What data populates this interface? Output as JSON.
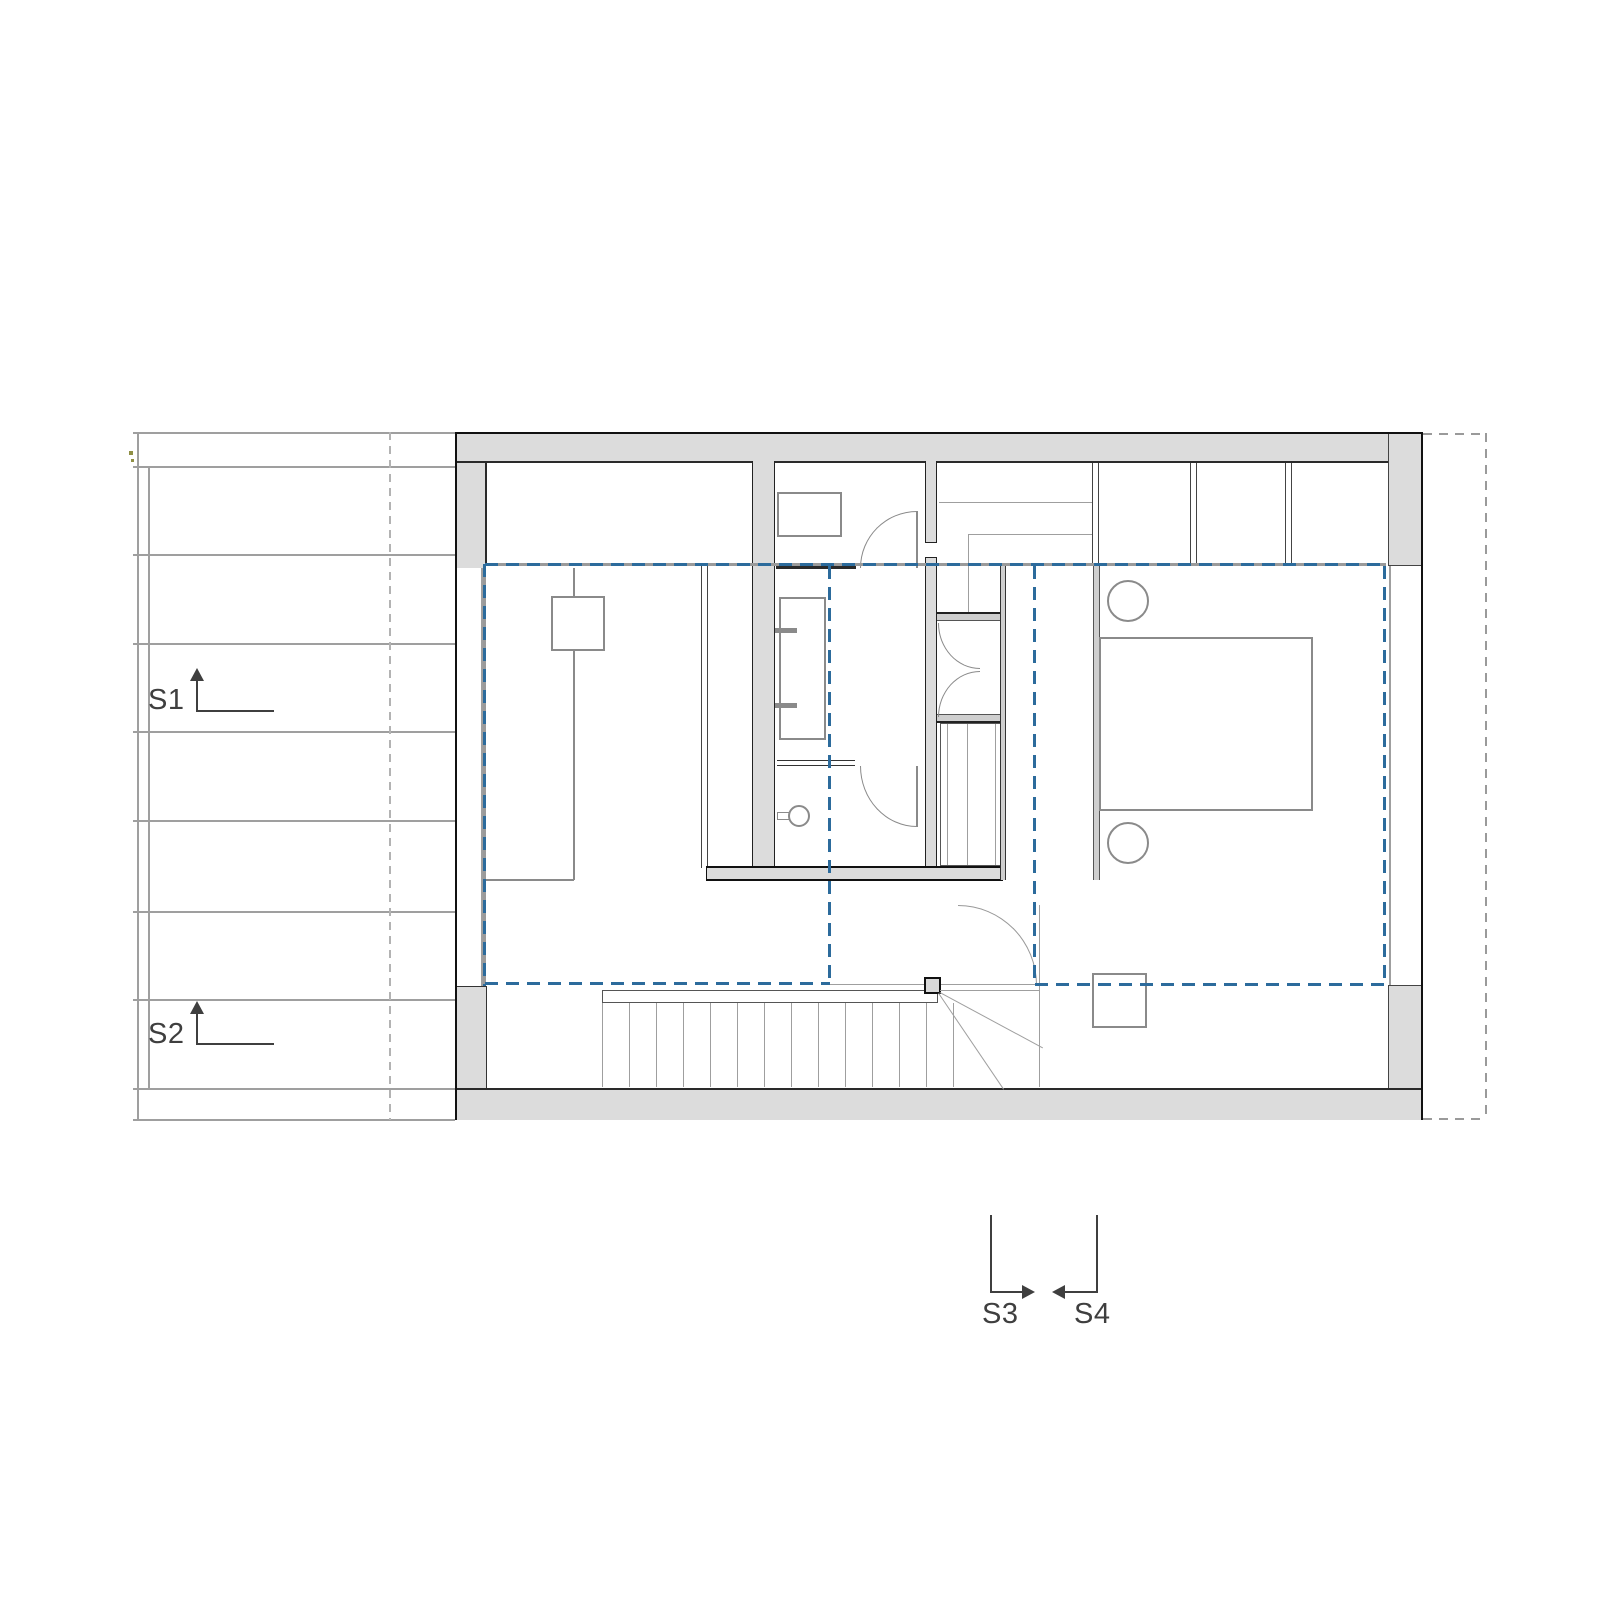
{
  "drawing": {
    "type": "architectural-floor-plan",
    "colors": {
      "accent_blue": "#2c6b9c",
      "wall_fill": "#dcdcdc",
      "line_gray": "#8a8a8a"
    },
    "section_markers": {
      "s1": {
        "label": "S1"
      },
      "s2": {
        "label": "S2"
      },
      "s3": {
        "label": "S3"
      },
      "s4": {
        "label": "S4"
      }
    }
  }
}
